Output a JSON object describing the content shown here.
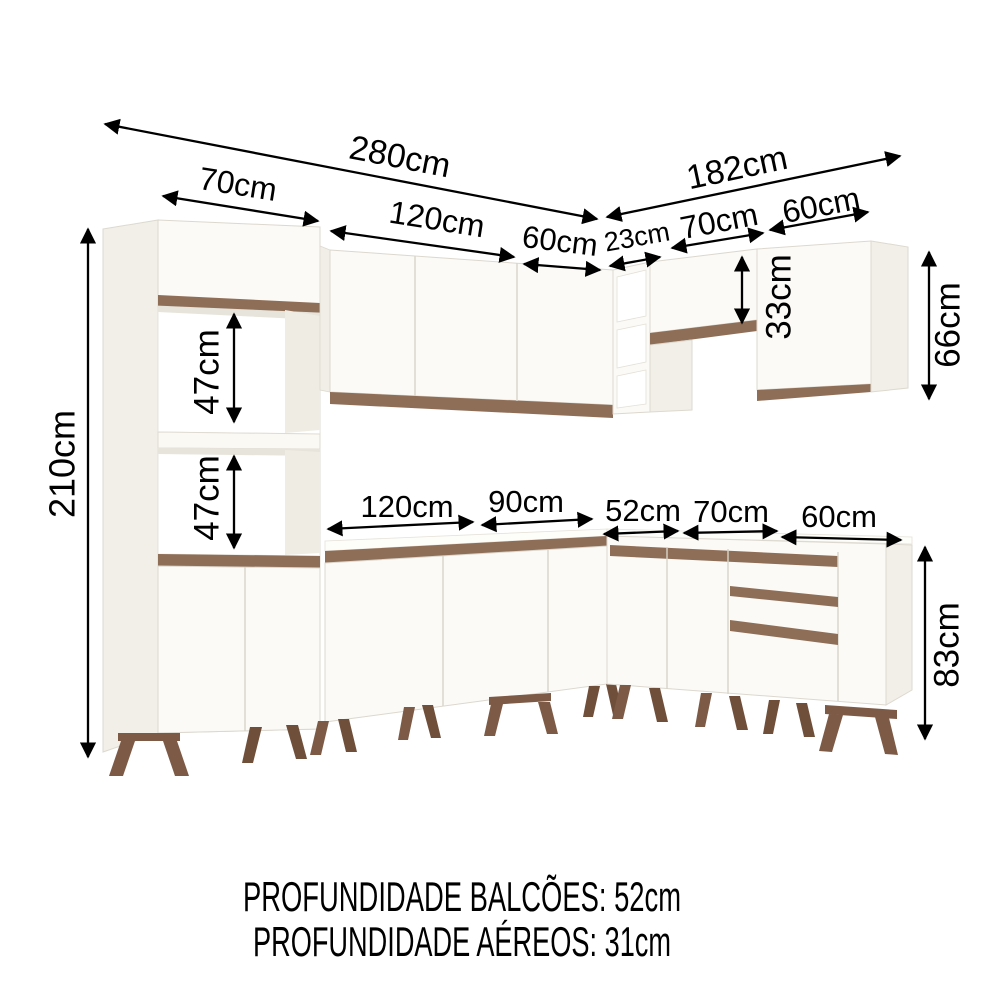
{
  "diagram": {
    "type": "kitchen-cabinet-dimension-diagram",
    "units": "cm"
  },
  "dims": [
    {
      "name": "left-run-total-width",
      "label": "280cm"
    },
    {
      "name": "right-run-total-width",
      "label": "182cm"
    },
    {
      "name": "tall-cabinet-width",
      "label": "70cm"
    },
    {
      "name": "upper-left-cabinet-width",
      "label": "120cm"
    },
    {
      "name": "upper-left-end-door-width",
      "label": "60cm"
    },
    {
      "name": "upper-corner-width",
      "label": "23cm"
    },
    {
      "name": "upper-right-cabinet-width",
      "label": "70cm"
    },
    {
      "name": "upper-right-end-cabinet-width",
      "label": "60cm"
    },
    {
      "name": "tall-cabinet-height",
      "label": "210cm"
    },
    {
      "name": "upper-niche-height",
      "label": "47cm"
    },
    {
      "name": "lower-niche-height",
      "label": "47cm"
    },
    {
      "name": "upper-right-cabinet-height",
      "label": "33cm"
    },
    {
      "name": "upper-right-end-cabinet-height",
      "label": "66cm"
    },
    {
      "name": "base-cabinet-height",
      "label": "83cm"
    },
    {
      "name": "base-120-width",
      "label": "120cm"
    },
    {
      "name": "base-90-width",
      "label": "90cm"
    },
    {
      "name": "base-corner-width",
      "label": "52cm"
    },
    {
      "name": "base-70-width",
      "label": "70cm"
    },
    {
      "name": "base-60-width",
      "label": "60cm"
    }
  ],
  "footer": {
    "line1": "PROFUNDIDADE BALCÕES: 52cm",
    "line2": "PROFUNDIDADE AÉREOS: 31cm"
  },
  "colors": {
    "background": "#ffffff",
    "cabinet": "#fbfaf6",
    "cabinet_side": "#f1efe7",
    "wood_trim": "#8f6e57",
    "legs": "#7d5a45",
    "dimension_lines": "#000000"
  }
}
